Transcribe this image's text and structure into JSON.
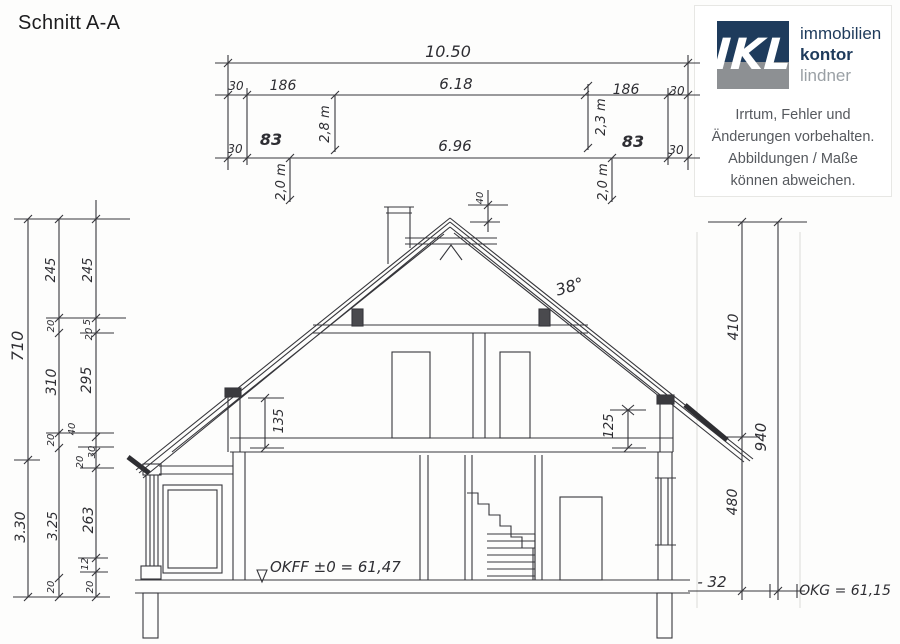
{
  "title": "Schnitt A-A",
  "logo": {
    "acronym": "IKL",
    "brand": [
      "immobilien",
      "kontor",
      "lindner"
    ],
    "disclaimer": [
      "Irrtum, Fehler und",
      "Änderungen vorbehalten.",
      "Abbildungen / Maße",
      "können abweichen."
    ],
    "colors": {
      "navy": "#1e3b5c",
      "square_gray": "#8d9093",
      "lindner_gray": "#9aa0a5",
      "disclaimer_gray": "#56595e"
    }
  },
  "dims": {
    "total": "10.50",
    "row2": [
      "30",
      "186",
      "6.18",
      "186",
      "30"
    ],
    "row3": [
      "30",
      "83",
      "6.96",
      "83",
      "30"
    ],
    "height_labels": {
      "upper_left": "2,8 m",
      "upper_right": "2,3 m",
      "lower_left": "2,0 m",
      "lower_right": "2,0 m"
    },
    "left_outer": [
      "710",
      "3.30"
    ],
    "left_mid": [
      "245",
      "20",
      "310",
      "20",
      "3.25",
      "20"
    ],
    "left_inner": [
      "245",
      "5",
      "20",
      "295",
      "40",
      "30",
      "20",
      "263",
      "12",
      "20"
    ],
    "right_inner": [
      "410",
      "480"
    ],
    "right_outer": "940",
    "interior": {
      "knee_left": "135",
      "knee_right": "125",
      "ridge": "40",
      "roof_angle": "38°"
    },
    "level_offset": "- 32"
  },
  "levels": {
    "okff": "OKFF ±0 = 61,47",
    "okg": "OKG = 61,15"
  }
}
